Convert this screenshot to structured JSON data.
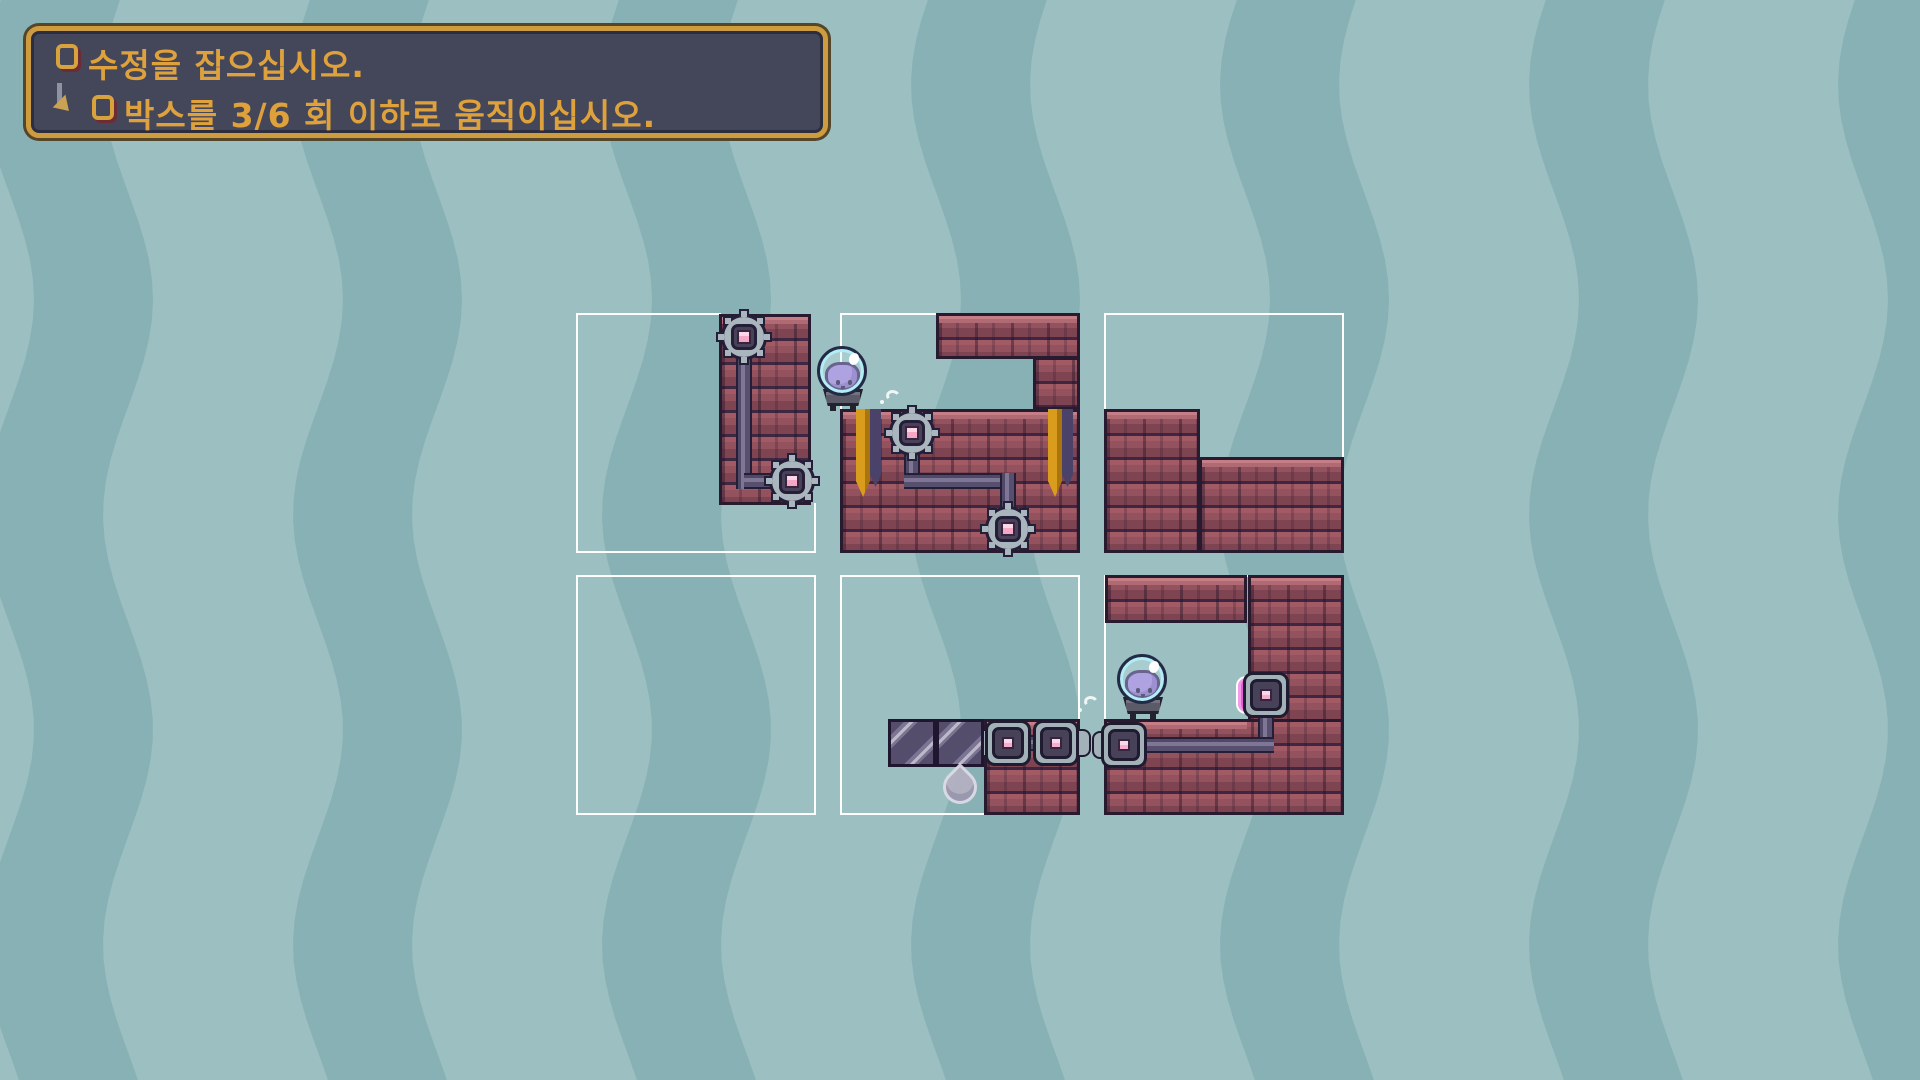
{
  "window": {
    "width": 1920,
    "height": 1080,
    "app": "slime-box-puzzle-game"
  },
  "hud": {
    "objectives": [
      {
        "icon": "checkbox",
        "checked": false,
        "text": "수정을 잡으십시오."
      },
      {
        "icon": "checkbox",
        "checked": false,
        "indent": true,
        "text": "박스를 3/6 회 이하로 움직이십시오.",
        "moves_used": 3,
        "moves_limit": 6
      }
    ]
  },
  "level": {
    "rooms": {
      "count": 6,
      "grid": "3x2",
      "outline": "white"
    },
    "entities": {
      "slimes": 2,
      "crystals": 1,
      "movable_boxes": 2,
      "gear_nodes": 4,
      "square_ports": 4,
      "gold_banners": 2,
      "active_port_glow": 1
    }
  },
  "palette": {
    "bg_dark": "#87b1b5",
    "bg_light": "#9cbfc1",
    "brick": "#93525e",
    "brick_cap": "#b06a73",
    "mortar": "#3f2641",
    "outline": "#281a2f",
    "pipe": "#574f6e",
    "node_metal": "#a9b6bd",
    "port_pink": "#f3a8c8",
    "magenta_glow": "#df5fd8",
    "slime_purple": "#a285da",
    "helmet_cyan": "#b2ecf4",
    "box_stripe_light": "#bcb7c9",
    "crystal_grey": "#b5b0c2",
    "banner_gold": "#d99c1c",
    "panel_bg": "#44465a",
    "panel_border": "#cd9c3f",
    "objective_text": "#dea13b",
    "room_line": "#ffffff"
  }
}
